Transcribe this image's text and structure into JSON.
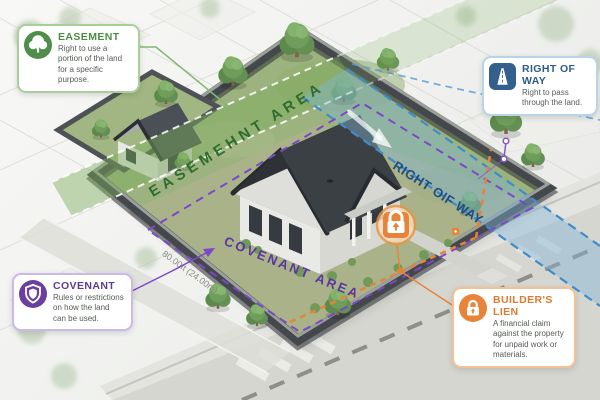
{
  "callouts": {
    "easement": {
      "title": "EASEMENT",
      "description": "Right to use a portion of the land for a specific purpose.",
      "icon": "tree-icon",
      "accent_color": "#4a8f43"
    },
    "right_of_way": {
      "title": "RIGHT OF WAY",
      "description": "Right to pass through the land.",
      "icon": "road-icon",
      "accent_color": "#2d5b88"
    },
    "covenant": {
      "title": "COVENANT",
      "description": "Rules or restrictions on how the land can be used.",
      "icon": "shield-icon",
      "accent_color": "#5d3a9a"
    },
    "builders_lien": {
      "title": "BUILDER'S LIEN",
      "description": "A financial claim against the property for unpaid work or materials.",
      "icon": "lock-icon",
      "accent_color": "#e07b2e"
    }
  },
  "map_labels": {
    "easement_area": "EASEMEHNT AREA",
    "right_of_way": "RIGHT OIF WAY",
    "covenant_area": "COVENANT AREA",
    "lot_dimension": "80.00ft (24.00m)"
  },
  "legend_colors": {
    "easement_band": "#7cae5e",
    "right_of_way_band": "#7fb6da",
    "covenant_dash": "#7a48c8",
    "builders_lien_dash": "#e8833a"
  }
}
